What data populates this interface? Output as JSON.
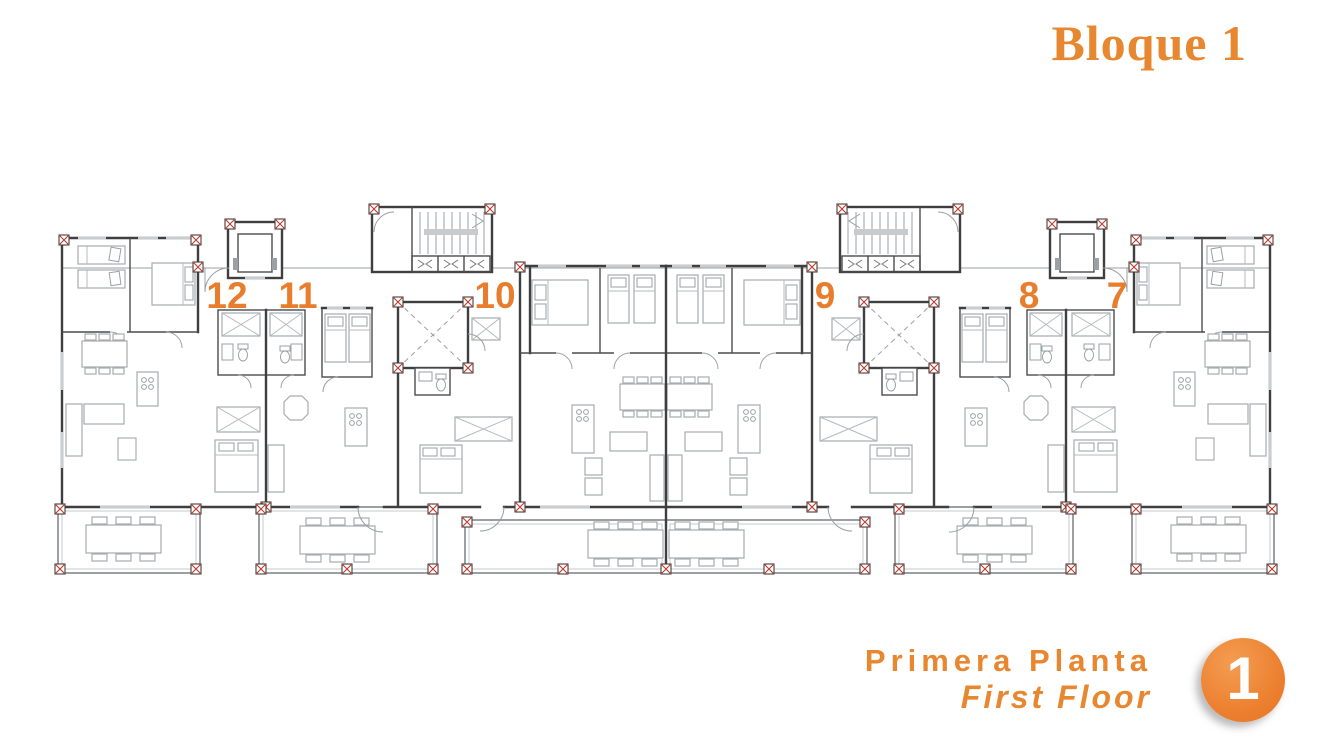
{
  "header": {
    "title": "Bloque 1"
  },
  "plan": {
    "units": [
      {
        "number": "12"
      },
      {
        "number": "11"
      },
      {
        "number": "10"
      },
      {
        "number": "9"
      },
      {
        "number": "8"
      },
      {
        "number": "7"
      }
    ]
  },
  "footer": {
    "floor_name_es": "Primera Planta",
    "floor_name_en": "First Floor",
    "badge": "1"
  },
  "colors": {
    "accent_orange": "#E7872F",
    "badge_orange": "#EC8030",
    "wall_gray": "#3F3F3F",
    "furniture_gray": "#A7ACB0",
    "column_red": "#C0392B"
  }
}
